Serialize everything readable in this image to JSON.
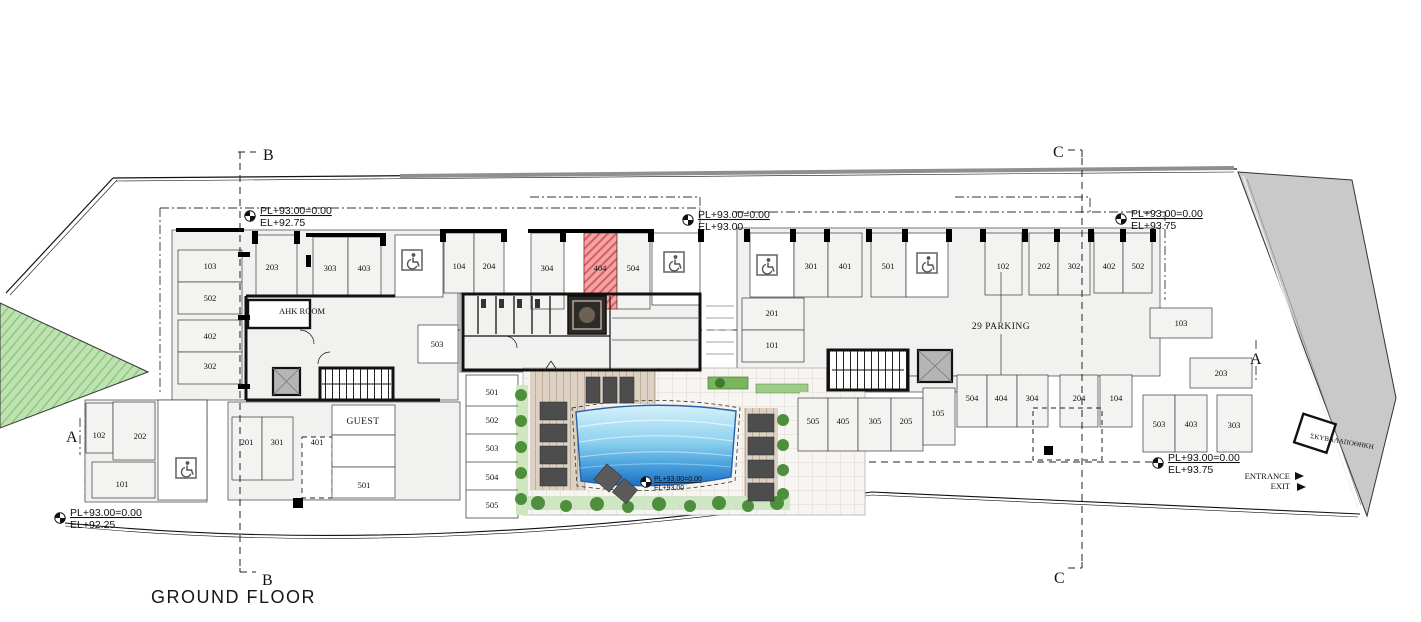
{
  "title": "GROUND FLOOR",
  "sections": {
    "a": "A",
    "b": "B",
    "c": "C"
  },
  "levels": {
    "top_left": {
      "pl": "PL+93.00=0.00",
      "el": "EL+92.75"
    },
    "top_mid": {
      "pl": "PL+93.00=0.00",
      "el": "EL+93.00"
    },
    "top_right": {
      "pl": "PL+93.00=0.00",
      "el": "EL+93.75"
    },
    "bottom_left": {
      "pl": "PL+93.00=0.00",
      "el": "EL+92.25"
    },
    "pool": {
      "pl": "PL+93.00=0.00",
      "el": "EL+93.00"
    },
    "bottom_right": {
      "pl": "PL+93.00=0.00",
      "el": "EL+93.75"
    }
  },
  "labels": {
    "ahk_room": "AHK ROOM",
    "guest": "GUEST",
    "parking_total": "29 PARKING",
    "waste_store": "ΣΚΥΒΑΛΑΠΟΘΗΚΗ",
    "entrance": "ENTRANCE",
    "exit": "EXIT"
  },
  "spaces": {
    "left_stack": [
      "103",
      "502",
      "402",
      "302"
    ],
    "row1": [
      "203",
      "303",
      "403"
    ],
    "row2": [
      "104",
      "204",
      "304",
      "404",
      "504"
    ],
    "row3": [
      "301",
      "401",
      "501"
    ],
    "row4": [
      "102",
      "202",
      "302",
      "402",
      "502"
    ],
    "mid_pair": [
      "201",
      "101"
    ],
    "right_mid": [
      "103",
      "203"
    ],
    "bottom_left": [
      "102",
      "202",
      "101"
    ],
    "bottom_mid": [
      "201",
      "301",
      "401",
      "501"
    ],
    "stores": [
      "501",
      "502",
      "503",
      "504",
      "505"
    ],
    "bottom_right_block": [
      "505",
      "405",
      "305",
      "205",
      "105"
    ],
    "bottom_right_row": [
      "504",
      "404",
      "304",
      "204",
      "104"
    ],
    "bottom_right_end": [
      "503",
      "403",
      "303"
    ]
  },
  "highlighted_space": "404",
  "colors": {
    "highlight": "#e89a98",
    "pool_top": "#d6f1fa",
    "pool_bottom": "#1c6ec2",
    "road": "#c9c9c9",
    "green": "#bfe2b2"
  }
}
